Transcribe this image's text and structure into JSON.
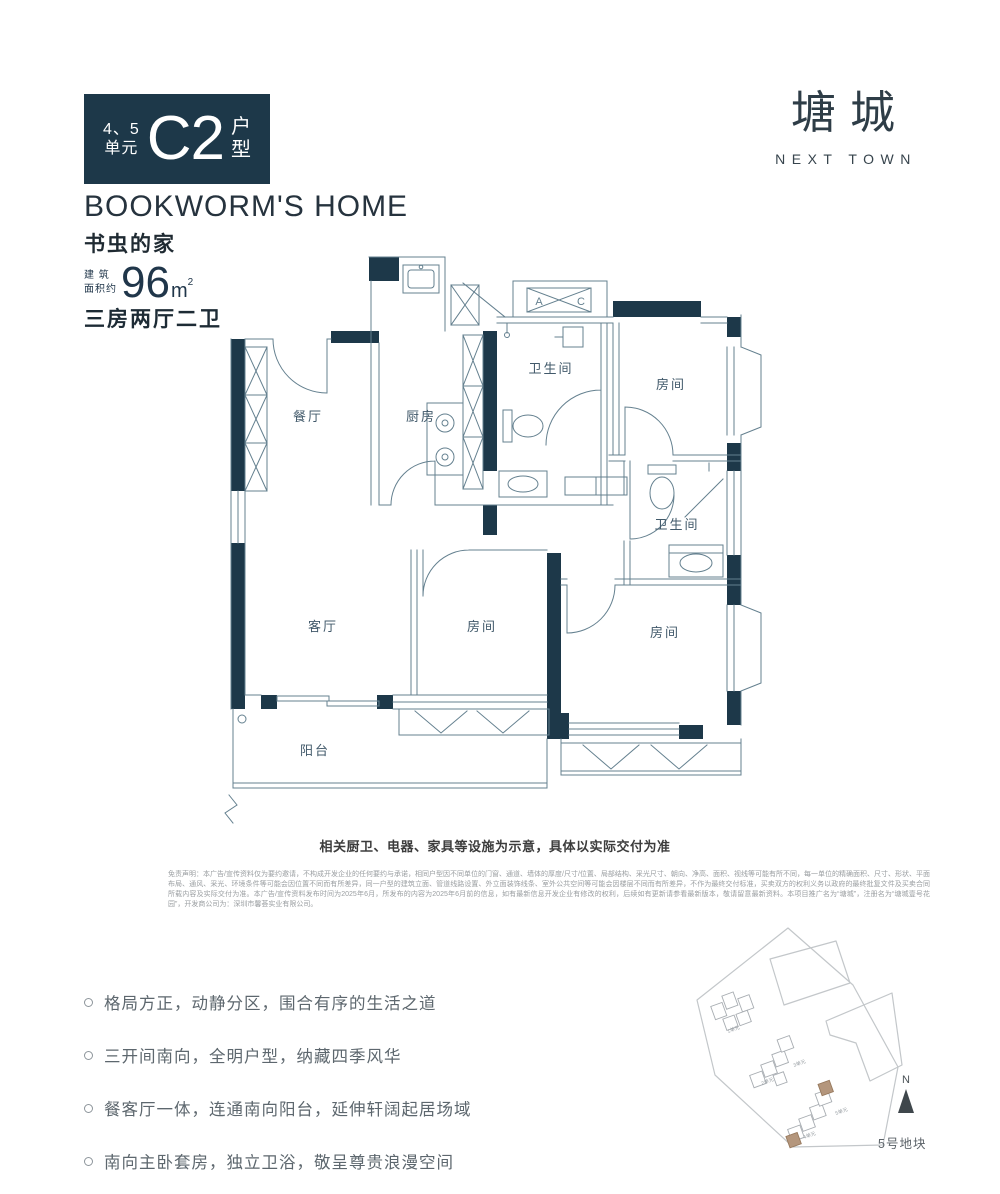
{
  "colors": {
    "navy": "#1d3849",
    "plan_line": "#64808f",
    "label": "#41596a",
    "highlight_tan": "#b4967c"
  },
  "badge": {
    "units_line1": "4、5",
    "units_line2": "单元",
    "type_code": "C2",
    "suffix_line1": "户",
    "suffix_line2": "型"
  },
  "logo": {
    "cn": "塘城",
    "en": "NEXT TOWN"
  },
  "title": {
    "en": "BOOKWORM'S HOME",
    "cn": "书虫的家"
  },
  "area": {
    "prefix_line1": "建 筑",
    "prefix_line2": "面积约",
    "value": "96",
    "unit": "m",
    "sup": "2"
  },
  "layout_type": "三房两厅二卫",
  "floor_plan": {
    "rooms": {
      "dining": "餐厅",
      "kitchen": "厨房",
      "bath1": "卫生间",
      "bedroom_top": "房间",
      "bath2": "卫生间",
      "living": "客厅",
      "bedroom_mid": "房间",
      "bedroom_right": "房间",
      "balcony": "阳台"
    },
    "ac_platform": {
      "a": "A",
      "c": "C"
    }
  },
  "plan_caption": "相关厨卫、电器、家具等设施为示意，具体以实际交付为准",
  "disclaimer": "免责声明：本广告/宣传资料仅为要约邀请，不构成开发企业的任何要约与承诺，相同户型因不同单位的门窗、通道、墙体的厚度/尺寸/位置、局部结构、采光尺寸、朝向、净高、面积、视线等可能有所不同，每一单位的精确面积、尺寸、形状、平面布局、通风、采光、环境条件等可能会因位置不同而有所差异，同一户型的建筑立面、管道线路设置、外立面装饰线条、室外公共空间等可能会因楼层不同而有所差异，不作为最终交付标准，买卖双方的权利义务以政府的最终批复文件及买卖合同所载内容及实际交付为准。本广告/宣传资料发布时间为2025年6月，所发布的内容为2025年6月前的信息，如有最新信息开发企业有修改的权利，后续如有更新请参看最新版本，敬请留意最新资料。本项目推广名为“塘城”，注册名为“塘城壹号花园”，开发商公司为：深圳市馨荟实业有限公司。",
  "selling_points": [
    "格局方正，动静分区，围合有序的生活之道",
    "三开间南向，全明户型，纳藏四季风华",
    "餐客厅一体，连通南向阳台，延伸轩阔起居场域",
    "南向主卧套房，独立卫浴，敬呈尊贵浪漫空间"
  ],
  "site_plan": {
    "north_label": "N",
    "plot_label": "5号地块",
    "unit_labels": [
      "1单元",
      "2单元",
      "3单元",
      "4单元",
      "5单元"
    ]
  }
}
